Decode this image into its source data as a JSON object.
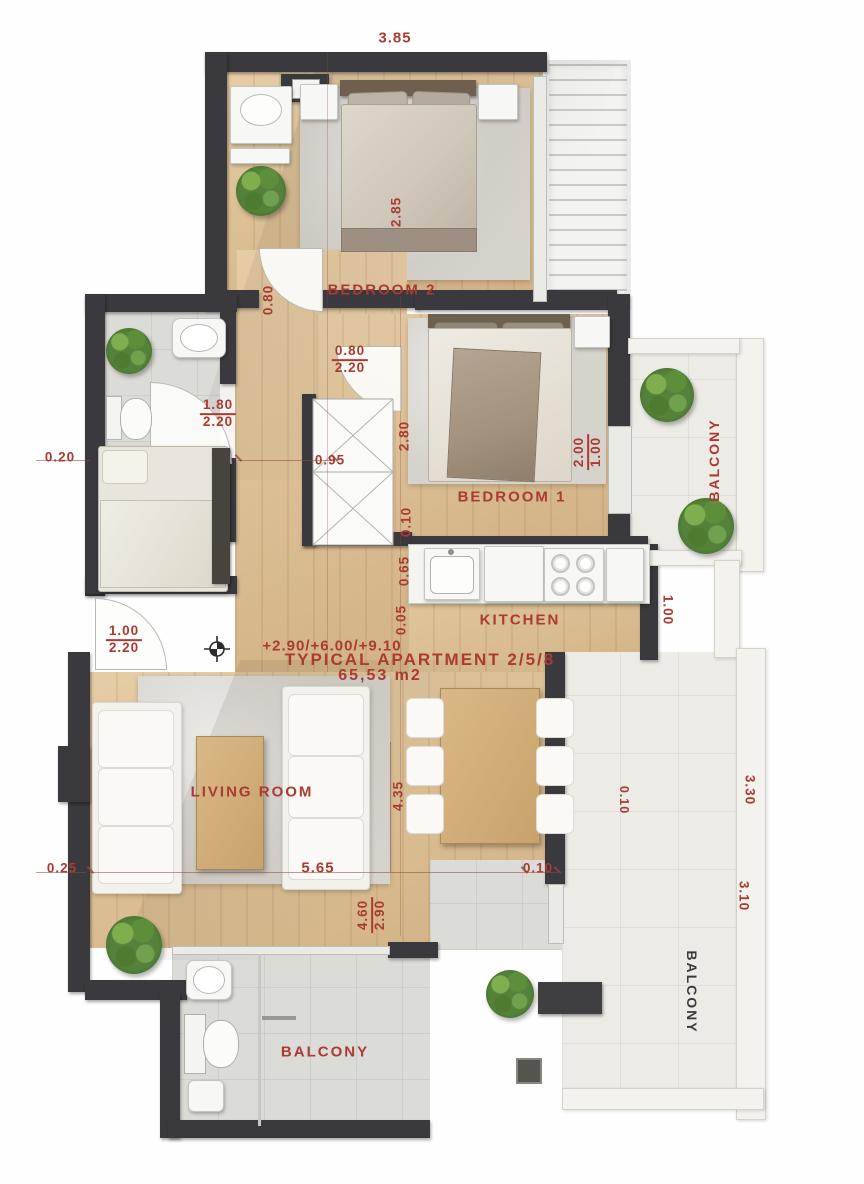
{
  "title": {
    "levels": "+2.90/+6.00/+9.10",
    "name": "TYPICAL APARTMENT 2/5/8",
    "area": "65,53 m2"
  },
  "rooms": {
    "bedroom2": "BEDROOM 2",
    "bedroom1": "BEDROOM 1",
    "kitchen": "KITCHEN",
    "living": "LIVING ROOM",
    "balcony_bottom": "BALCONY",
    "balcony_upper_right": "BALCONY",
    "balcony_lower_right": "BALCONY"
  },
  "doors": {
    "bedroom1": {
      "w": "0.80",
      "h": "2.20"
    },
    "bathroom": {
      "w": "1.80",
      "h": "2.20"
    },
    "entrance": {
      "w": "1.00",
      "h": "2.20"
    },
    "bedroom1_window": {
      "w": "2.00",
      "h": "1.00"
    }
  },
  "dims": {
    "top_width": "3.85",
    "bed2_depth": "2.85",
    "hall_door": "0.80",
    "corridor": "0.95",
    "bed1_depth": "2.80",
    "bed1_offset": "0.10",
    "kitchen_offset_a": "0.65",
    "kitchen_offset_b": "0.05",
    "balcony_edge": "1.00",
    "left_offset_a": "0.20",
    "left_offset_b": "0.25",
    "living_width": "5.65",
    "living_offset": "0.10",
    "living_depth": "4.35",
    "balcony_depth_a": "4.60",
    "balcony_depth_b": "2.90",
    "right_offset": "0.10",
    "right_width_a": "3.30",
    "right_width_b": "3.10"
  },
  "colors": {
    "annotation": "#a93b32",
    "wall": "#3a3a3e",
    "wood": "#ddc197",
    "tile": "#dbdbd8",
    "balcony_tile": "#edebe5"
  }
}
